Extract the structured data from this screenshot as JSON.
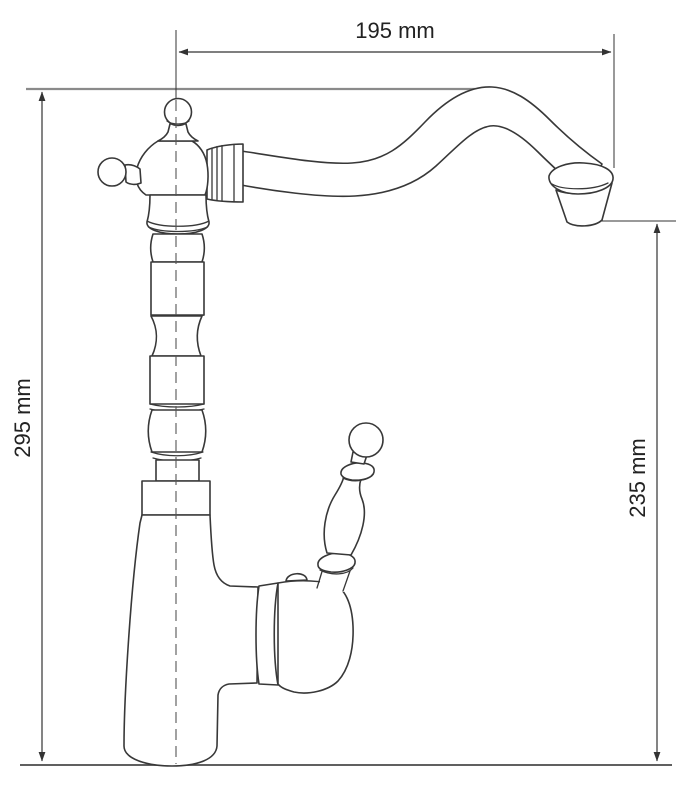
{
  "drawing": {
    "subject": "single-lever kitchen faucet with swan-neck spout, dimensioned side view",
    "labels": {
      "spout_reach": "195 mm",
      "total_height": "295 mm",
      "spout_outlet_height": "235 mm"
    },
    "values": {
      "spout_reach_mm": 195,
      "total_height_mm": 295,
      "spout_outlet_height_mm": 235
    },
    "colors": {
      "outline": "#383838",
      "dimension_line": "#333333",
      "reference_line": "#8a8a8a",
      "baseline": "#4a4a4a",
      "centerline": "#555555",
      "text": "#222222",
      "background": "#ffffff"
    }
  }
}
